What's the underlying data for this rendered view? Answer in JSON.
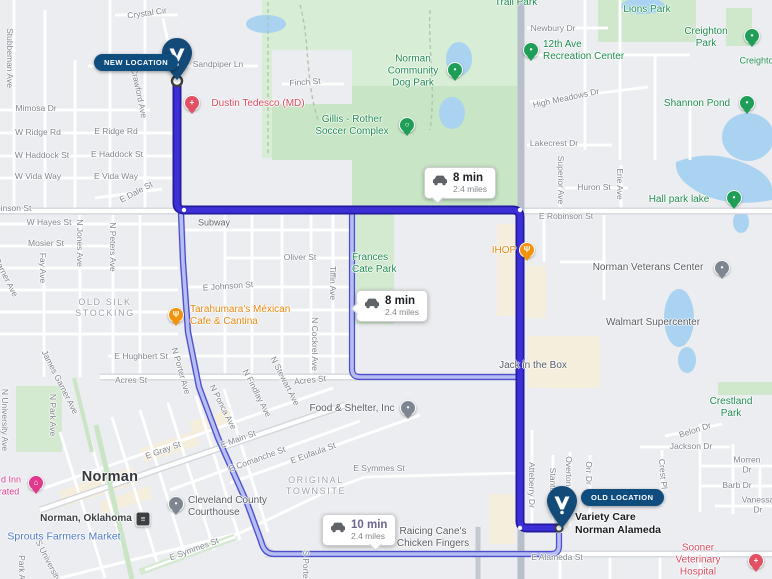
{
  "map_name": "norman-oklahoma-route-map",
  "location_pills": {
    "new": "NEW LOCATION",
    "old": "OLD LOCATION"
  },
  "route_badges": [
    {
      "time": "8 min",
      "dist": "2.4 miles"
    },
    {
      "time": "8 min",
      "dist": "2.4 miles"
    },
    {
      "time": "10 min",
      "dist": "2.4 miles"
    }
  ],
  "colors": {
    "route_main": "#3d2fd6",
    "route_main_casing": "#231a9e",
    "route_alt": "#b6bff2",
    "route_alt_casing": "#4e4dcf",
    "marker_navy": "#134a78",
    "pill_navy": "#0f4d7e",
    "park_green": "#d8edd6",
    "park_green_dark": "#c8e5c5",
    "water_blue": "#a9d3f1",
    "poi_green": "#1d8a4e",
    "poi_orange": "#e8860f",
    "poi_red": "#d8495f",
    "poi_blue": "#4a78c4",
    "poi_pink": "#df3a8e",
    "commercial_tan": "#f6eedd"
  },
  "labels": [
    {
      "t": "Stubbeman Ave",
      "x": 10,
      "y": 58,
      "c": "st",
      "r": 90
    },
    {
      "t": "Crystal Cir",
      "x": 147,
      "y": 13,
      "c": "st",
      "r": -8
    },
    {
      "t": "Falcon Ct",
      "x": 121,
      "y": 60,
      "c": "st",
      "r": -14
    },
    {
      "t": "Sandpiper Ln",
      "x": 218,
      "y": 64,
      "c": "st"
    },
    {
      "t": "Finch St",
      "x": 305,
      "y": 82,
      "c": "st",
      "r": -4
    },
    {
      "t": "Crawford Ave",
      "x": 139,
      "y": 93,
      "c": "st",
      "r": 78
    },
    {
      "t": "Mimosa Dr",
      "x": 36,
      "y": 108,
      "c": "st"
    },
    {
      "t": "W Ridge Rd",
      "x": 38,
      "y": 132,
      "c": "st"
    },
    {
      "t": "E Ridge Rd",
      "x": 116,
      "y": 131,
      "c": "st"
    },
    {
      "t": "W Haddock St",
      "x": 42,
      "y": 155,
      "c": "st"
    },
    {
      "t": "E Haddock St",
      "x": 117,
      "y": 154,
      "c": "st"
    },
    {
      "t": "W Vida Way",
      "x": 38,
      "y": 176,
      "c": "st"
    },
    {
      "t": "E Vida Way",
      "x": 116,
      "y": 176,
      "c": "st"
    },
    {
      "t": "E Dale St",
      "x": 136,
      "y": 192,
      "c": "st",
      "r": -28
    },
    {
      "t": "W Robinson St",
      "x": 3,
      "y": 208,
      "c": "st"
    },
    {
      "t": "E Robinson St",
      "x": 566,
      "y": 216,
      "c": "st"
    },
    {
      "t": "W Hayes St",
      "x": 49,
      "y": 222,
      "c": "st"
    },
    {
      "t": "Mosier St",
      "x": 46,
      "y": 243,
      "c": "st"
    },
    {
      "t": "Fay Ave",
      "x": 43,
      "y": 268,
      "c": "st",
      "r": 90
    },
    {
      "t": "N Jones Ave",
      "x": 80,
      "y": 243,
      "c": "st",
      "r": 90
    },
    {
      "t": "N Peters Ave",
      "x": 113,
      "y": 247,
      "c": "st",
      "r": 90
    },
    {
      "t": "Garner Ave",
      "x": 6,
      "y": 277,
      "c": "st",
      "r": 63
    },
    {
      "t": "James Garner Ave",
      "x": 60,
      "y": 382,
      "c": "st",
      "r": 63
    },
    {
      "t": "E Hughbert St",
      "x": 141,
      "y": 356,
      "c": "st"
    },
    {
      "t": "Acres St",
      "x": 131,
      "y": 380,
      "c": "st"
    },
    {
      "t": "Acres St",
      "x": 310,
      "y": 380,
      "c": "st",
      "r": -6
    },
    {
      "t": "N Porter Ave",
      "x": 181,
      "y": 371,
      "c": "st",
      "r": 74
    },
    {
      "t": "N Ponca Ave",
      "x": 223,
      "y": 407,
      "c": "st",
      "r": 63
    },
    {
      "t": "N Findlay Ave",
      "x": 257,
      "y": 393,
      "c": "st",
      "r": 63
    },
    {
      "t": "N Stewart Ave",
      "x": 285,
      "y": 381,
      "c": "st",
      "r": 63
    },
    {
      "t": "N Cockrel Ave",
      "x": 315,
      "y": 344,
      "c": "st",
      "r": 90
    },
    {
      "t": "Tiffin Ave",
      "x": 333,
      "y": 283,
      "c": "st",
      "r": 90
    },
    {
      "t": "Oliver St",
      "x": 300,
      "y": 257,
      "c": "st"
    },
    {
      "t": "E Johnson St",
      "x": 228,
      "y": 286,
      "c": "st",
      "r": -4
    },
    {
      "t": "Newbury Dr",
      "x": 553,
      "y": 28,
      "c": "st"
    },
    {
      "t": "High Meadows Dr",
      "x": 566,
      "y": 98,
      "c": "st",
      "r": -12
    },
    {
      "t": "Lakecrest Dr",
      "x": 554,
      "y": 143,
      "c": "st"
    },
    {
      "t": "Huron St",
      "x": 594,
      "y": 187,
      "c": "st"
    },
    {
      "t": "Superior Ave",
      "x": 561,
      "y": 180,
      "c": "st",
      "r": 90
    },
    {
      "t": "Erie Ave",
      "x": 620,
      "y": 184,
      "c": "st",
      "r": 90
    },
    {
      "t": "Belon Dr",
      "x": 695,
      "y": 430,
      "c": "st",
      "r": -18
    },
    {
      "t": "Jackson Dr",
      "x": 691,
      "y": 446,
      "c": "st"
    },
    {
      "t": "Morren Dr",
      "x": 747,
      "y": 465,
      "c": "st"
    },
    {
      "t": "Barb Dr",
      "x": 737,
      "y": 485,
      "c": "st"
    },
    {
      "t": "Vanessa Dr",
      "x": 758,
      "y": 505,
      "c": "st"
    },
    {
      "t": "Crest Pl",
      "x": 663,
      "y": 474,
      "c": "st",
      "r": 85
    },
    {
      "t": "Atteberry Dr",
      "x": 532,
      "y": 485,
      "c": "st",
      "r": 90
    },
    {
      "t": "Stanton Dr",
      "x": 553,
      "y": 488,
      "c": "st",
      "r": 90
    },
    {
      "t": "Overton Dr",
      "x": 569,
      "y": 477,
      "c": "st",
      "r": 90
    },
    {
      "t": "Orr Dr",
      "x": 589,
      "y": 473,
      "c": "st",
      "r": 90
    },
    {
      "t": "E Symmes St",
      "x": 379,
      "y": 468,
      "c": "st"
    },
    {
      "t": "E Symmes St",
      "x": 194,
      "y": 549,
      "c": "st",
      "r": -20
    },
    {
      "t": "E Eufaula St",
      "x": 313,
      "y": 453,
      "c": "st",
      "r": -20
    },
    {
      "t": "E Comanche St",
      "x": 257,
      "y": 459,
      "c": "st",
      "r": -20
    },
    {
      "t": "E Main St",
      "x": 238,
      "y": 439,
      "c": "st",
      "r": -20
    },
    {
      "t": "E Gray St",
      "x": 163,
      "y": 450,
      "c": "st",
      "r": -20
    },
    {
      "t": "E Alameda St",
      "x": 557,
      "y": 557,
      "c": "st"
    },
    {
      "t": "S University Ave",
      "x": 52,
      "y": 568,
      "c": "st",
      "r": 63
    },
    {
      "t": "Park Ave",
      "x": 22,
      "y": 572,
      "c": "st",
      "r": 90
    },
    {
      "t": "N Park Ave",
      "x": 53,
      "y": 415,
      "c": "st",
      "r": 90
    },
    {
      "t": "N University Ave",
      "x": 5,
      "y": 420,
      "c": "st",
      "r": 90
    },
    {
      "t": "S Porter Ave",
      "x": 306,
      "y": 574,
      "c": "st",
      "r": 90
    },
    {
      "t": "OLD SILK\nSTOCKING",
      "x": 105,
      "y": 308,
      "c": "area"
    },
    {
      "t": "ORIGINAL\nTOWNSITE",
      "x": 316,
      "y": 486,
      "c": "area"
    },
    {
      "t": "Norman",
      "x": 110,
      "y": 478,
      "c": "city"
    },
    {
      "t": "Subway",
      "x": 214,
      "y": 223,
      "c": "poi"
    },
    {
      "t": "Walmart Supercenter",
      "x": 653,
      "y": 323,
      "c": "poi2"
    },
    {
      "t": "Jack in the Box",
      "x": 533,
      "y": 366,
      "c": "poi2"
    },
    {
      "t": "Food & Shelter, Inc",
      "x": 352,
      "y": 409,
      "c": "poi2"
    },
    {
      "t": "Norman Veterans Center",
      "x": 648,
      "y": 268,
      "c": "poi2"
    },
    {
      "t": "Cleveland County\nCourthouse",
      "x": 188,
      "y": 507,
      "c": "poi2",
      "a": "l"
    },
    {
      "t": "Raicing Cane's\nChicken Fingers",
      "x": 433,
      "y": 538,
      "c": "poi2"
    },
    {
      "t": "Norman, Oklahoma",
      "x": 86,
      "y": 519,
      "c": "poid"
    },
    {
      "t": "Variety Care\nNorman Alameda",
      "x": 575,
      "y": 524,
      "c": "poib",
      "a": "l"
    },
    {
      "t": "Norman\nCommunity\nDog Park",
      "x": 413,
      "y": 72,
      "c": "pg2"
    },
    {
      "t": "Gillis - Rother\nSoccer Complex",
      "x": 352,
      "y": 126,
      "c": "pg2"
    },
    {
      "t": "12th Ave\nRecreation Center",
      "x": 543,
      "y": 51,
      "c": "pg2",
      "a": "l"
    },
    {
      "t": "Lions Park",
      "x": 647,
      "y": 10,
      "c": "pg2"
    },
    {
      "t": "Trail Park",
      "x": 516,
      "y": 3,
      "c": "pg2"
    },
    {
      "t": "Creighton Park",
      "x": 706,
      "y": 38,
      "c": "pg2"
    },
    {
      "t": "Creighton",
      "x": 759,
      "y": 61,
      "c": "pg"
    },
    {
      "t": "Shannon Pond",
      "x": 697,
      "y": 104,
      "c": "pg2"
    },
    {
      "t": "Hall park lake",
      "x": 679,
      "y": 200,
      "c": "pg2"
    },
    {
      "t": "Crestland Park",
      "x": 731,
      "y": 408,
      "c": "pg2"
    },
    {
      "t": "Frances\nCate Park",
      "x": 352,
      "y": 264,
      "c": "pg2",
      "a": "l"
    },
    {
      "t": "Tarahumara's Méxican\nCafe & Cantina",
      "x": 190,
      "y": 316,
      "c": "po",
      "a": "l"
    },
    {
      "t": "IHOP",
      "x": 504,
      "y": 251,
      "c": "po"
    },
    {
      "t": "Dustin Tedesco (MD)",
      "x": 258,
      "y": 104,
      "c": "pr"
    },
    {
      "t": "Sooner Veterinary\nHospital",
      "x": 698,
      "y": 561,
      "c": "pr"
    },
    {
      "t": "Sprouts Farmers Market",
      "x": 64,
      "y": 537,
      "c": "pblue"
    },
    {
      "t": "d Inn",
      "x": 11,
      "y": 480,
      "c": "ppink"
    },
    {
      "t": "rated",
      "x": 9,
      "y": 492,
      "c": "ppink"
    }
  ],
  "pins": [
    {
      "x": 455,
      "y": 70,
      "c": "green",
      "g": "•",
      "n": "dog-park-icon"
    },
    {
      "x": 407,
      "y": 125,
      "c": "green",
      "g": "○",
      "n": "soccer-icon"
    },
    {
      "x": 531,
      "y": 50,
      "c": "green",
      "g": "•",
      "n": "recreation-center-icon"
    },
    {
      "x": 752,
      "y": 36,
      "c": "green",
      "g": "•",
      "n": "creighton-park-icon"
    },
    {
      "x": 747,
      "y": 103,
      "c": "green",
      "g": "•",
      "n": "shannon-pond-icon"
    },
    {
      "x": 734,
      "y": 198,
      "c": "green",
      "g": "•",
      "n": "hall-park-lake-icon"
    },
    {
      "x": 192,
      "y": 103,
      "c": "red",
      "g": "+",
      "n": "doctor-icon"
    },
    {
      "x": 176,
      "y": 315,
      "c": "orange",
      "g": "Ψ",
      "n": "restaurant-icon"
    },
    {
      "x": 527,
      "y": 250,
      "c": "orange",
      "g": "Ψ",
      "n": "restaurant-icon"
    },
    {
      "x": 408,
      "y": 408,
      "c": "gray",
      "g": "•",
      "n": "shelter-icon"
    },
    {
      "x": 722,
      "y": 268,
      "c": "gray",
      "g": "•",
      "n": "veterans-center-icon"
    },
    {
      "x": 176,
      "y": 504,
      "c": "gray",
      "g": "•",
      "n": "courthouse-icon"
    },
    {
      "x": 36,
      "y": 483,
      "c": "pink",
      "g": "⌂",
      "n": "hotel-icon"
    },
    {
      "x": 756,
      "y": 561,
      "c": "red",
      "g": "+",
      "n": "veterinary-icon"
    },
    {
      "x": 143,
      "y": 519,
      "c": "dark",
      "g": "≡",
      "n": "train-station-icon"
    }
  ]
}
